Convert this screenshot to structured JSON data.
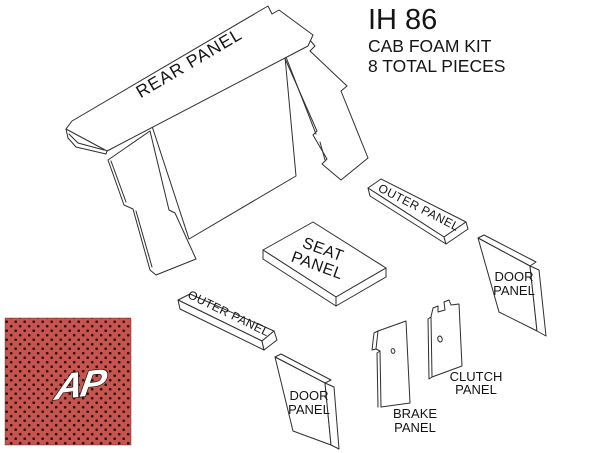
{
  "title": {
    "model": "IH 86",
    "kit_name": "CAB FOAM KIT",
    "piece_count": "8 TOTAL PIECES"
  },
  "panels": {
    "rear": {
      "label": "REAR PANEL"
    },
    "outer_upper": {
      "label": "OUTER PANEL"
    },
    "outer_lower": {
      "label": "OUTER PANEL"
    },
    "seat": {
      "line1": "SEAT",
      "line2": "PANEL"
    },
    "door_right": {
      "line1": "DOOR",
      "line2": "PANEL"
    },
    "door_lower": {
      "line1": "DOOR",
      "line2": "PANEL"
    },
    "brake": {
      "line1": "BRAKE",
      "line2": "PANEL"
    },
    "clutch": {
      "line1": "CLUTCH",
      "line2": "PANEL"
    }
  },
  "swatch": {
    "logo_text": "AP",
    "fabric_color": "#c65550",
    "dot_color": "#30100e",
    "logo_fill": "#ffffff",
    "logo_outline": "#1c0908"
  },
  "diagram": {
    "line_color": "#2e2e2e",
    "background": "#ffffff"
  }
}
